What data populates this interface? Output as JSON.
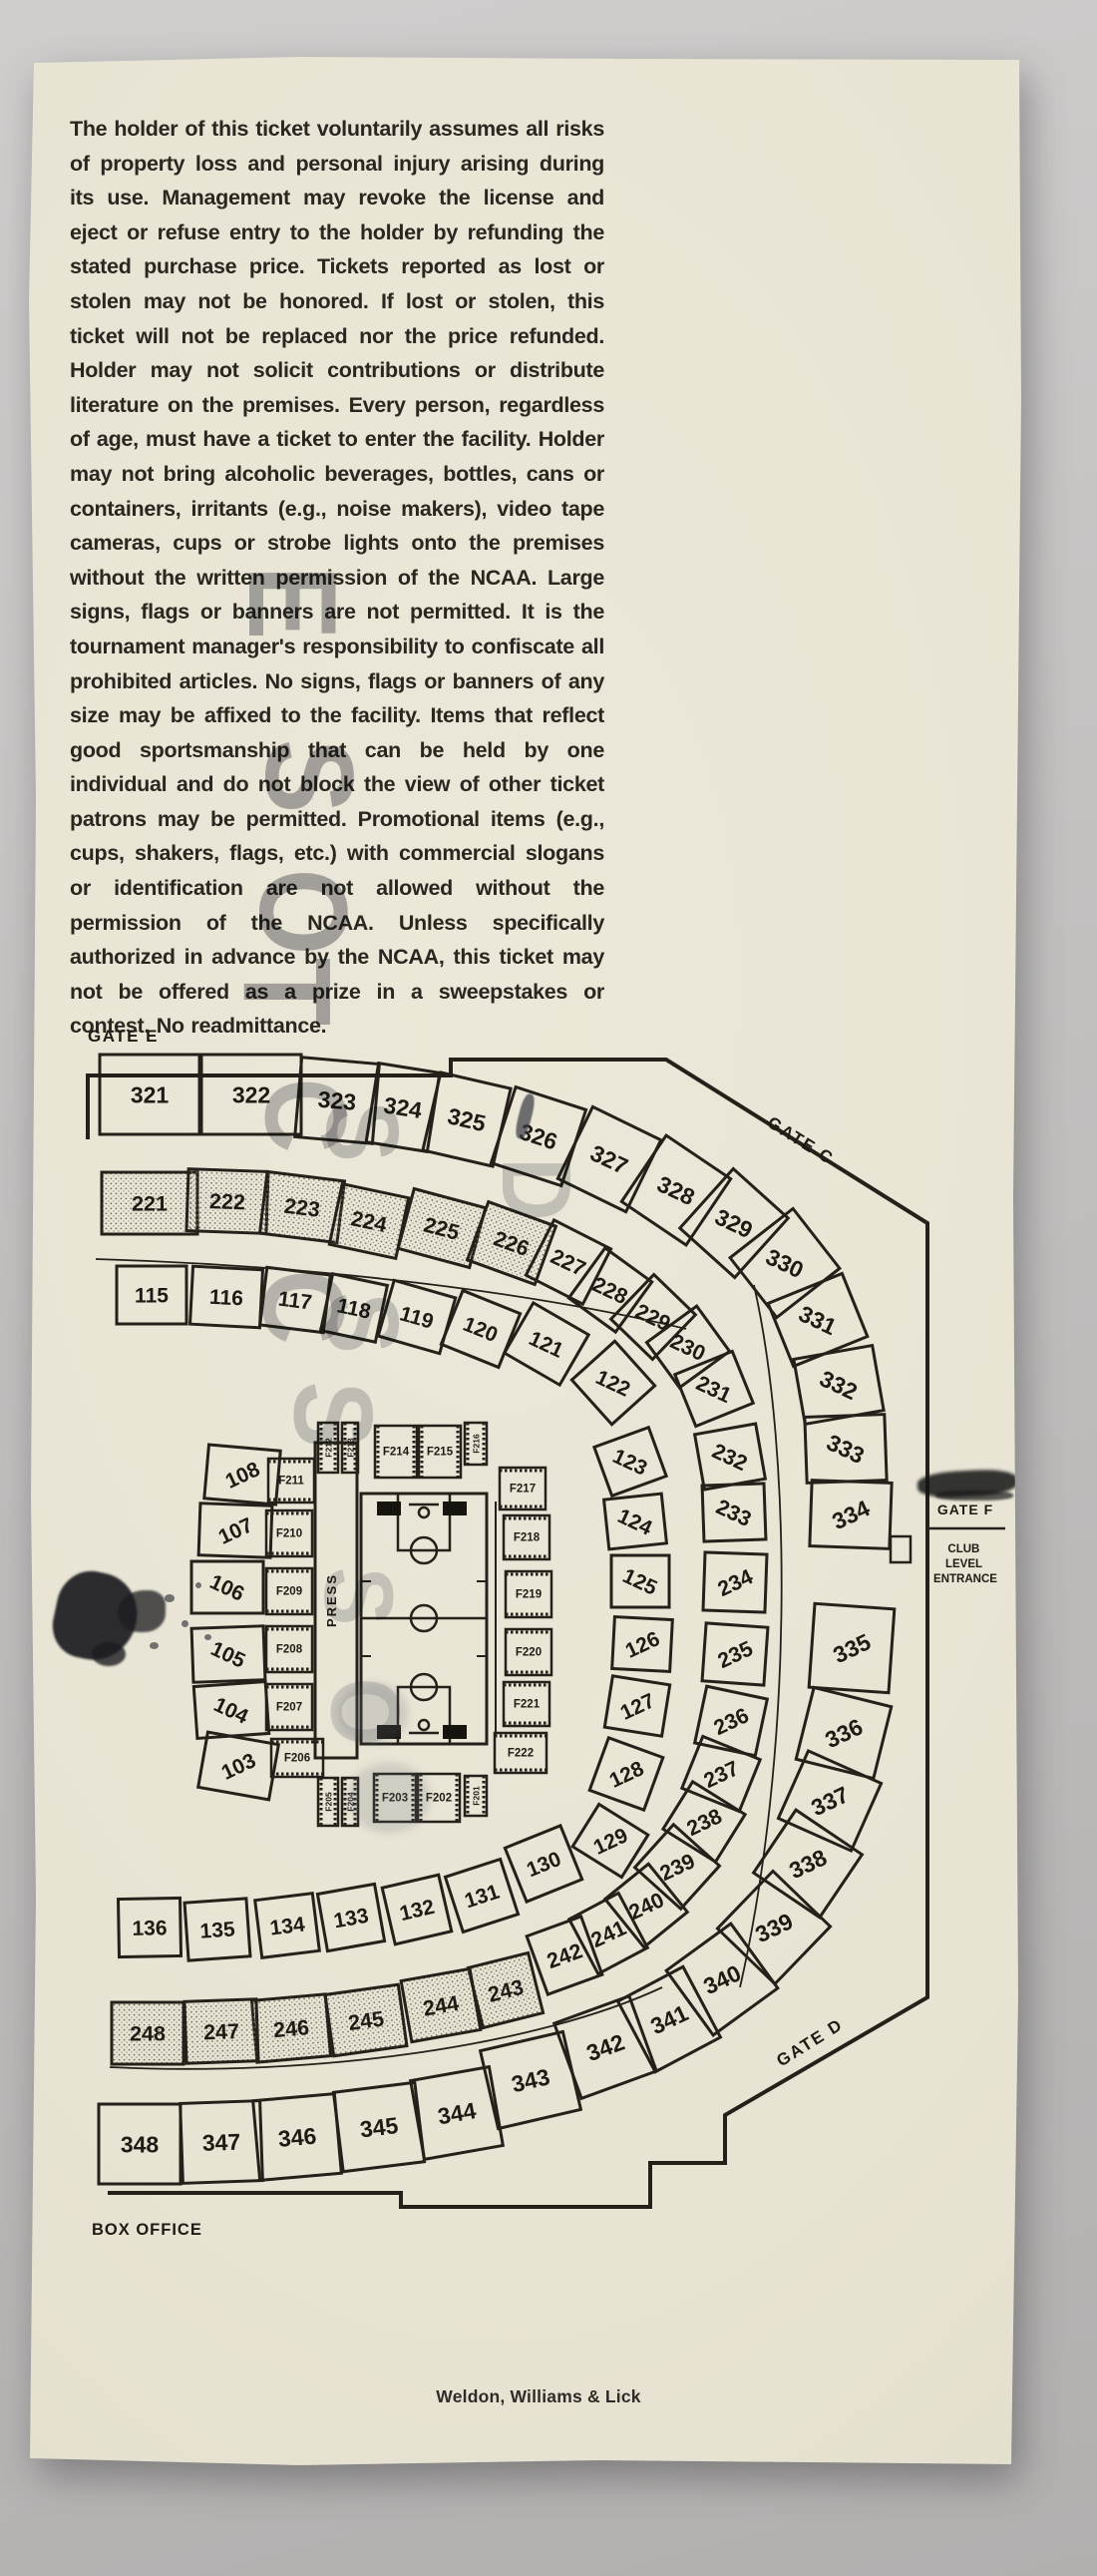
{
  "colors": {
    "paper": "#e8e4d4",
    "ink": "#23211a",
    "stamp": "#626270",
    "photo_bg": "#c3c1c0"
  },
  "ticket": {
    "legal_text": "The holder of this ticket voluntarily assumes all risks of property loss and personal injury arising during its use. Management may revoke the license and eject or refuse entry to the holder by refunding the stated purchase price. Tickets reported as lost or stolen may not be honored. If lost or stolen, this ticket will not be replaced nor the price refunded. Holder may not solicit contributions or distribute literature on the premises. Every person, regardless of age, must have a ticket to enter the facility. Holder may not bring alcoholic beverages, bottles, cans or containers, irritants (e.g., noise makers), video tape cameras, cups or strobe lights onto the premises without the written permission of the NCAA. Large signs, flags or banners are not permitted. It is the tournament manager's responsibility to confiscate all prohibited articles. No signs, flags or banners of any size may be affixed to the facility. Items that reflect good sportsmanship that can be held by one individual and do not block the view of other ticket patrons may be permitted. Promotional items (e.g., cups, shakers, flags, etc.) with commercial slogans or identification are not allowed without the permission of the NCAA. Unless specifically authorized in advance by the NCAA, this ticket may not be offered as a prize in a sweepstakes or contest. No readmittance.",
    "printer": "Weldon, Williams & Lick"
  },
  "stamp": {
    "fragments": [
      "E",
      "S",
      "O",
      "T",
      "C",
      "S",
      "C",
      "S",
      "S",
      "D",
      "S",
      "O"
    ]
  },
  "map": {
    "gates": {
      "gate_e": "GATE E",
      "gate_c": "GATE C",
      "gate_d": "GATE D",
      "gate_f": "GATE F"
    },
    "club_lines": [
      "CLUB",
      "LEVEL",
      "ENTRANCE"
    ],
    "box_office": "BOX OFFICE",
    "press": "PRESS",
    "rings": {
      "outer": {
        "sections": [
          "321",
          "322",
          "323",
          "324",
          "325",
          "326",
          "327",
          "328",
          "329",
          "330",
          "331",
          "332",
          "333",
          "334",
          "335",
          "336",
          "337",
          "338",
          "339",
          "340",
          "341",
          "342",
          "343",
          "344",
          "345",
          "346",
          "347",
          "348"
        ]
      },
      "middle": {
        "sections": [
          "221",
          "222",
          "223",
          "224",
          "225",
          "226",
          "227",
          "228",
          "229",
          "230",
          "231",
          "232",
          "233",
          "234",
          "235",
          "236",
          "237",
          "238",
          "239",
          "240",
          "241",
          "242",
          "243",
          "244",
          "245",
          "246",
          "247",
          "248"
        ],
        "hatched": [
          "221",
          "222",
          "223",
          "224",
          "225",
          "226",
          "243",
          "244",
          "245",
          "246",
          "247",
          "248"
        ]
      },
      "inner": {
        "sections": [
          "115",
          "116",
          "117",
          "118",
          "119",
          "120",
          "121",
          "122",
          "123",
          "124",
          "125",
          "126",
          "127",
          "128",
          "129",
          "130",
          "131",
          "132",
          "133",
          "134",
          "135",
          "136",
          "108",
          "107",
          "106",
          "105",
          "104",
          "103"
        ]
      }
    },
    "floor": {
      "left": [
        "F211",
        "F210",
        "F209",
        "F208",
        "F207",
        "F206"
      ],
      "top": [
        "F212",
        "F213",
        "F214",
        "F215",
        "F216"
      ],
      "right": [
        "F217",
        "F218",
        "F219",
        "F220",
        "F221",
        "F222"
      ],
      "bottom": [
        "F205",
        "F204",
        "F203",
        "F202",
        "F201"
      ]
    }
  }
}
